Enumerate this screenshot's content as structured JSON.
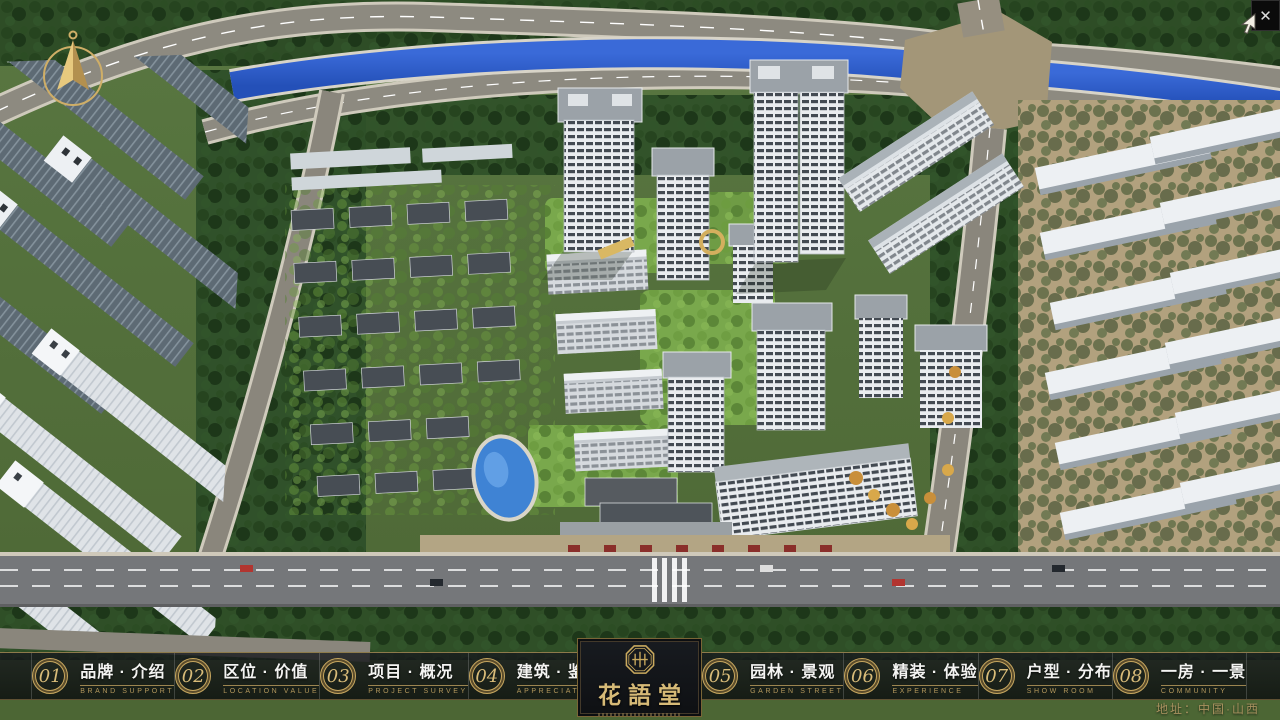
{
  "window": {
    "close_glyph": "✕"
  },
  "nav": {
    "items": [
      {
        "num": "01",
        "label": "品牌 · 介绍",
        "sub": "BRAND SUPPORT"
      },
      {
        "num": "02",
        "label": "区位 · 价值",
        "sub": "LOCATION VALUE"
      },
      {
        "num": "03",
        "label": "项目 · 概况",
        "sub": "PROJECT SURVEY"
      },
      {
        "num": "04",
        "label": "建筑 · 鉴赏",
        "sub": "APPRECIATION"
      },
      {
        "num": "05",
        "label": "园林 · 景观",
        "sub": "GARDEN STREET"
      },
      {
        "num": "06",
        "label": "精装 · 体验",
        "sub": "EXPERIENCE"
      },
      {
        "num": "07",
        "label": "户型 · 分布",
        "sub": "SHOW ROOM"
      },
      {
        "num": "08",
        "label": "一房 · 一景",
        "sub": "COMMUNITY"
      }
    ]
  },
  "logo": {
    "name": "花語堂"
  },
  "footer": {
    "address": "地址：中国·山西"
  },
  "icons": {
    "close": "close-x",
    "compass": "north-arrow-compass",
    "seal": "octagonal-seal"
  },
  "colors": {
    "gold": "#c7a75f",
    "bar_background": "rgba(16,18,22,0.80)",
    "river_blue": "#2f5cc9",
    "pool_blue": "#3f83d4",
    "lawn_green": "#79a84c",
    "forest_green": "#26441f",
    "road_gray": "#8d8a80",
    "tower_white": "#e9ecef"
  }
}
